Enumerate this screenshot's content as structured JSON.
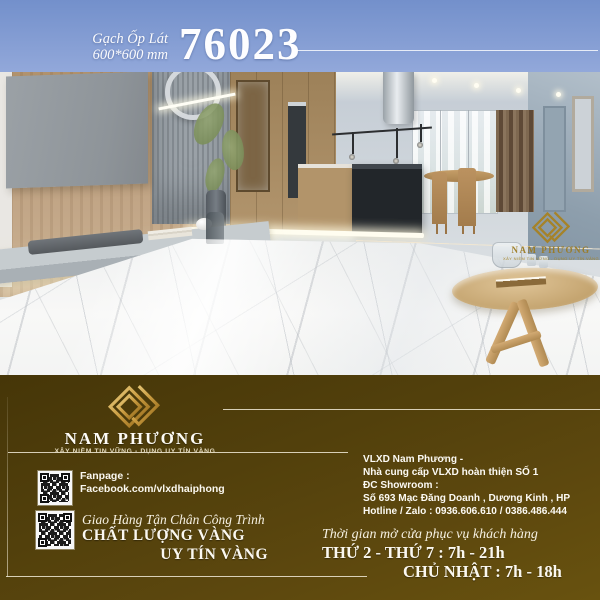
{
  "header": {
    "product_type": "Gạch Ốp Lát",
    "product_size": "600*600 mm",
    "product_code": "76023"
  },
  "photo": {
    "description": "modern-kitchen-living-room-with-white-marble-floor-tiles",
    "watermark": {
      "brand": "NAM PHƯƠNG",
      "tagline": "XÂY NIỀM TIN VỮNG - DỤNG UY TÍN VÀNG"
    }
  },
  "footer": {
    "brand": {
      "name": "NAM PHƯƠNG",
      "tagline": "XÂY NIỀM TIN VỮNG - DỤNG UY TÍN VÀNG"
    },
    "fanpage": {
      "label": "Fanpage :",
      "url": "Facebook.com/vlxdhaiphong"
    },
    "delivery": {
      "line1": "Giao Hàng Tận Chân Công Trình",
      "line2": "CHẤT LƯỢNG VÀNG",
      "line3": "UY TÍN VÀNG"
    },
    "company": {
      "line1": "VLXD Nam Phương -",
      "line2": "Nhà cung cấp VLXD hoàn thiện SỐ 1",
      "line3": "ĐC Showroom :",
      "line4": "Số 693 Mạc Đăng Doanh , Dương Kinh , HP",
      "line5": "Hotline / Zalo : 0936.606.610 / 0386.486.444"
    },
    "hours": {
      "intro": "Thời gian mở cửa phục vụ khách hàng",
      "weekdays": "THỨ 2 - THỨ 7 : 7h - 21h",
      "sunday": "CHỦ NHẬT : 7h - 18h"
    }
  },
  "icons": {
    "qr_fanpage": "qr-code-icon",
    "qr_delivery": "qr-code-icon",
    "brand_logo": "interlocked-diamond-logo-icon"
  },
  "colors": {
    "header_blue": "#849dd3",
    "footer_brown": "#55420c",
    "gold": "#c89a3f",
    "rule_cream": "#f0e9d6",
    "text_white": "#fbf8f0"
  }
}
